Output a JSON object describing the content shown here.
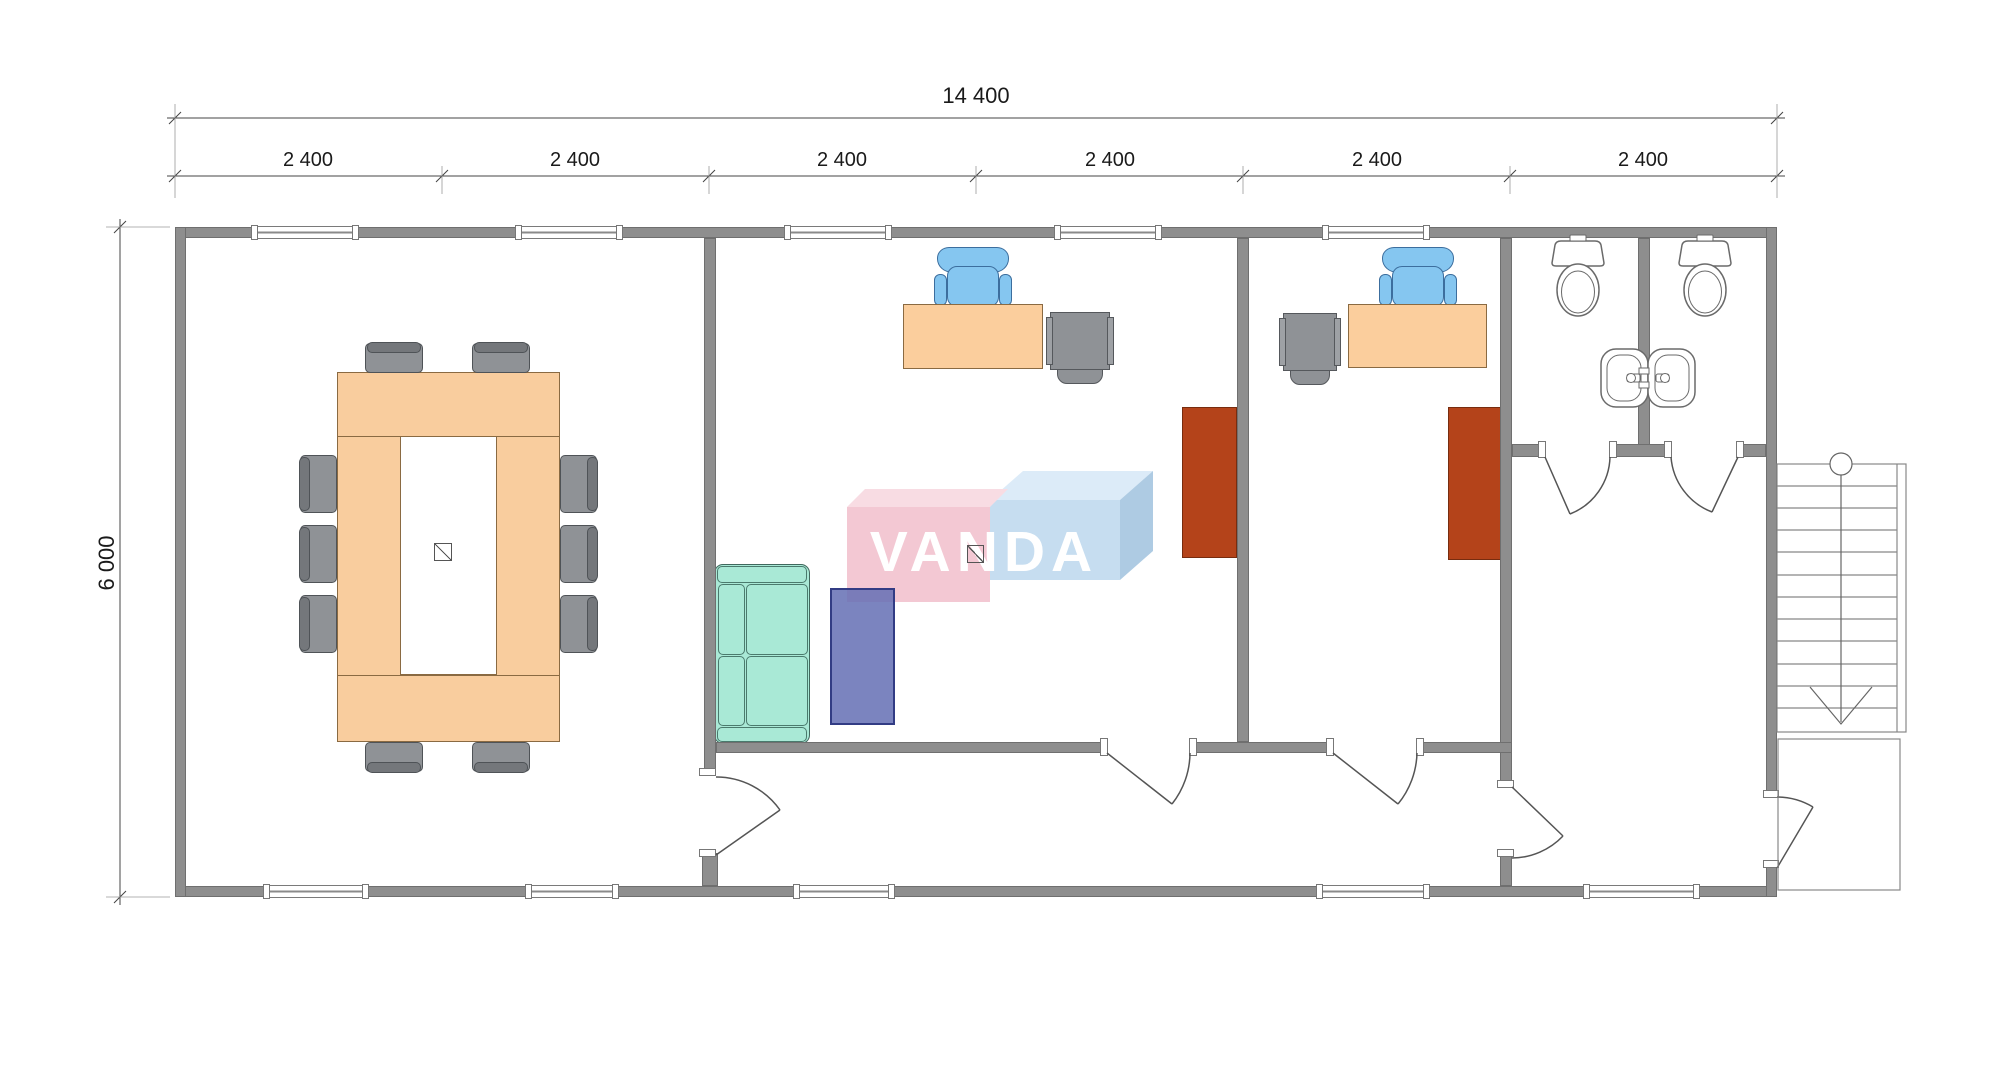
{
  "watermark": {
    "text": "VANDA",
    "pink_front": "#F3C8D3",
    "pink_top": "#F8DCE3",
    "blue_front": "#C6DDF0",
    "blue_top": "#DCEBF8",
    "blue_side": "#AECBE3",
    "text_color": "#FFFFFF"
  },
  "dimensions": {
    "total_width_label": "14 400",
    "height_label": "6 000",
    "module_labels": [
      "2 400",
      "2 400",
      "2 400",
      "2 400",
      "2 400",
      "2 400"
    ]
  },
  "colors": {
    "wall": "#8E8E8E",
    "wood_furniture": "#F9CD9E",
    "gray_chair": "#8F9296",
    "office_chair_blue": "#85C6F0",
    "sofa_teal": "#A9E9D6",
    "mat_purple": "#6D76B6",
    "panel_brown": "#B4431A",
    "fixture_line": "#666666"
  },
  "plan": {
    "rooms": [
      "conference-room",
      "office-1",
      "office-2",
      "corridor",
      "wc-stall-1",
      "wc-stall-2",
      "vestibule"
    ],
    "exterior": [
      "staircase",
      "landing"
    ],
    "furniture": [
      "conference-table",
      "conference-chairs-x10",
      "desk-1",
      "desk-chair-1",
      "cabinet-1",
      "sofa",
      "floor-mat",
      "wardrobe-panel-1",
      "desk-2",
      "desk-chair-2",
      "cabinet-2",
      "wardrobe-panel-2",
      "toilet-1",
      "toilet-2",
      "sink-pair",
      "floor-symbol-1",
      "floor-symbol-2"
    ]
  }
}
